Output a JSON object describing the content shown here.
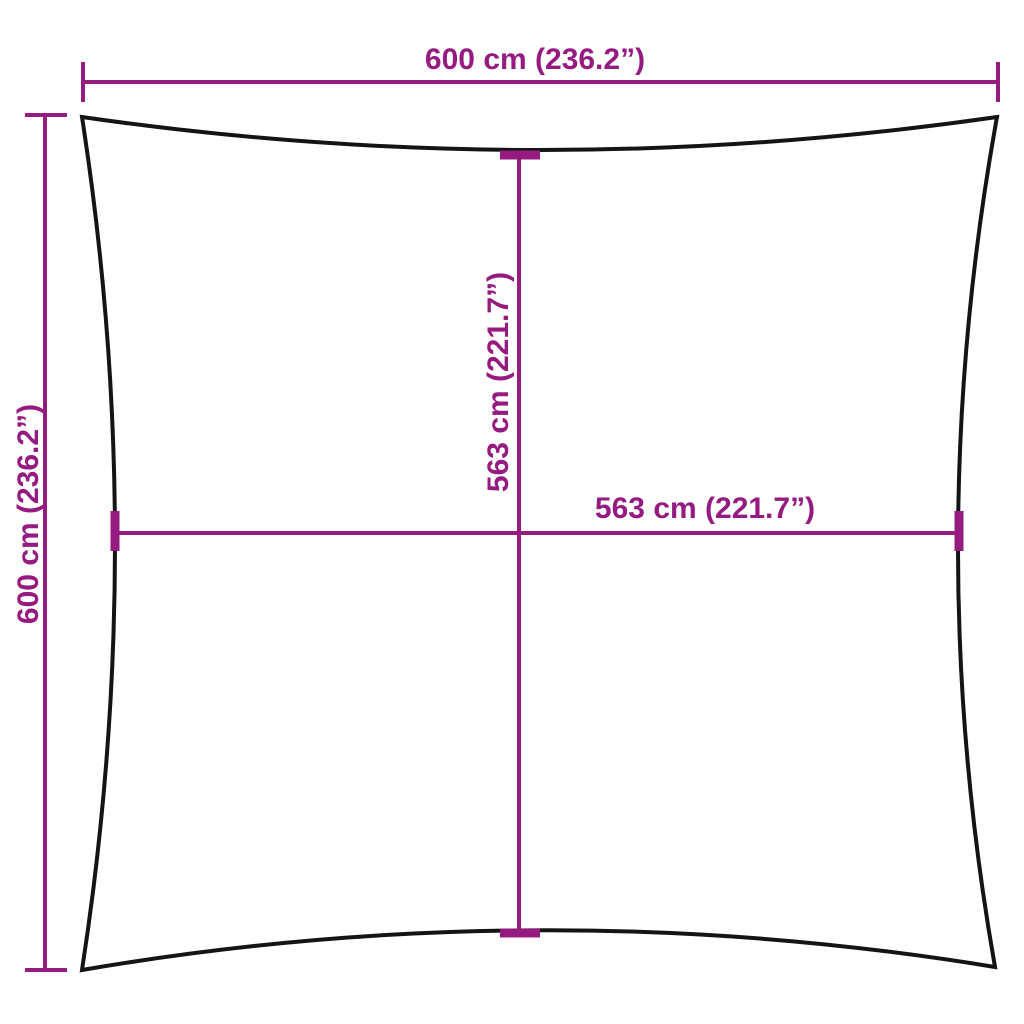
{
  "diagram": {
    "labels": {
      "top_width": "600 cm (236.2”)",
      "left_height": "600 cm (236.2”)",
      "inner_height": "563 cm (221.7”)",
      "inner_width": "563 cm (221.7”)"
    },
    "colors": {
      "dimension": "#951b81",
      "outline": "#141414",
      "background": "#ffffff"
    }
  }
}
